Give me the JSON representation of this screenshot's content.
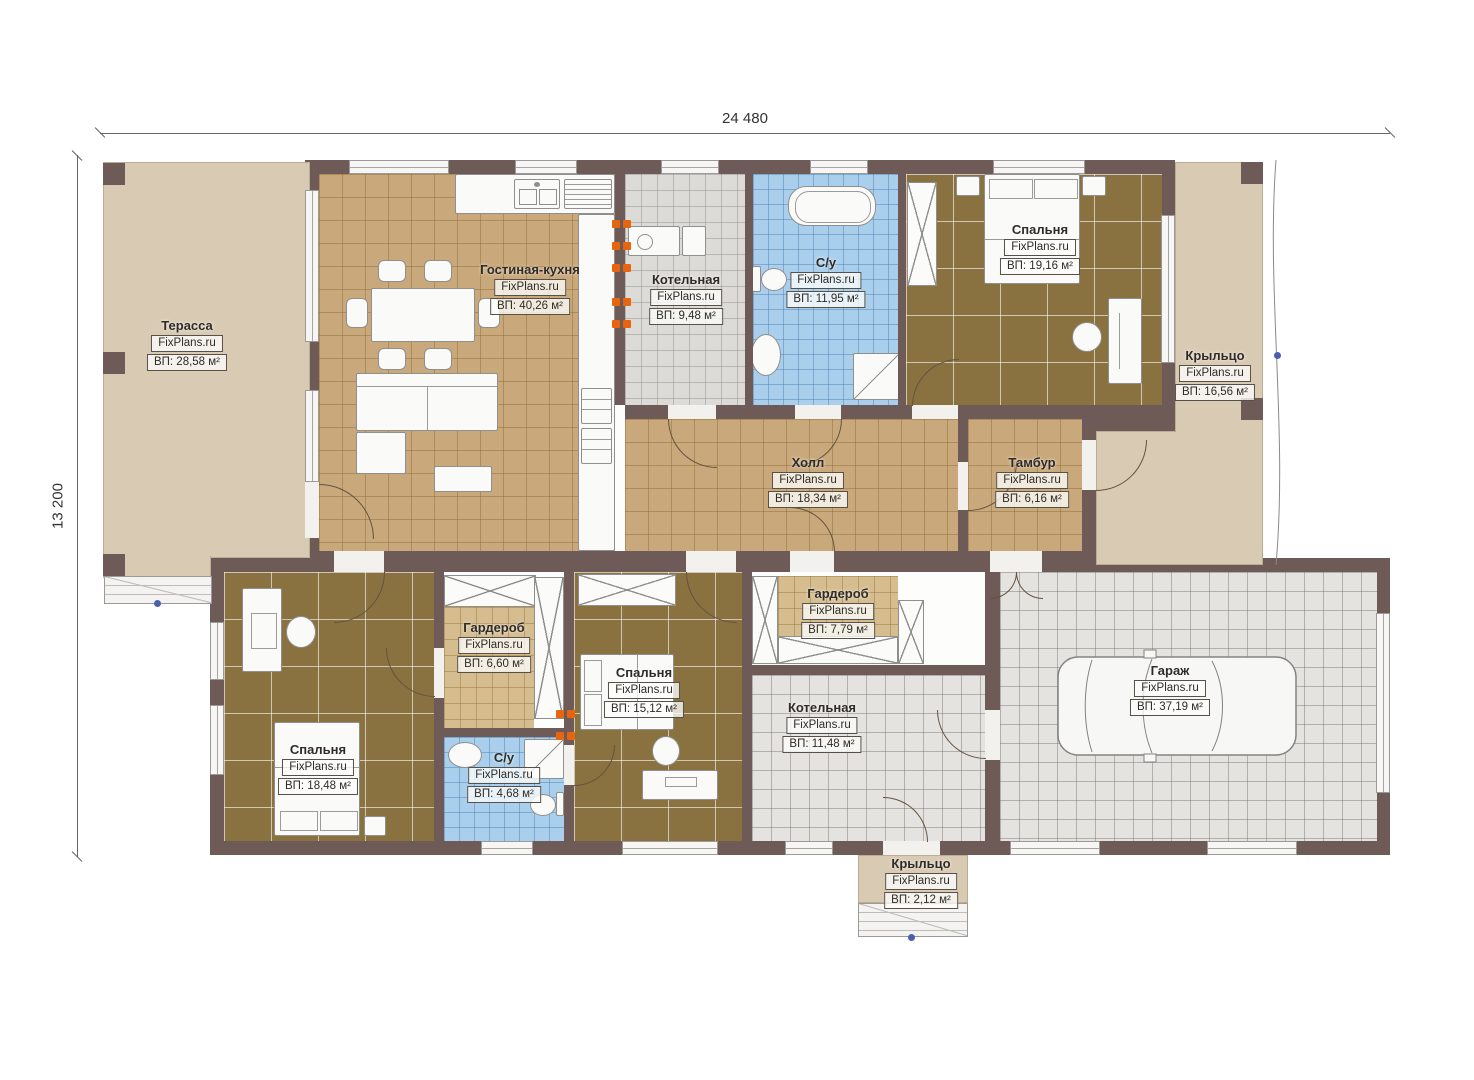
{
  "watermark": "FixPlans.ru",
  "dimensions": {
    "width": "24 480",
    "height": "13 200"
  },
  "rooms": [
    {
      "name": "Терасса",
      "area": "ВП: 28,58 м²"
    },
    {
      "name": "Гостиная-кухня",
      "area": "ВП: 40,26 м²"
    },
    {
      "name": "Котельная",
      "area": "ВП: 9,48 м²"
    },
    {
      "name": "С/у",
      "area": "ВП: 11,95 м²"
    },
    {
      "name": "Спальня",
      "area": "ВП: 19,16 м²"
    },
    {
      "name": "Крыльцо",
      "area": "ВП: 16,56 м²"
    },
    {
      "name": "Холл",
      "area": "ВП: 18,34 м²"
    },
    {
      "name": "Тамбур",
      "area": "ВП: 6,16 м²"
    },
    {
      "name": "Спальня",
      "area": "ВП: 18,48 м²"
    },
    {
      "name": "Гардероб",
      "area": "ВП: 6,60 м²"
    },
    {
      "name": "С/у",
      "area": "ВП: 4,68 м²"
    },
    {
      "name": "Спальня",
      "area": "ВП: 15,12 м²"
    },
    {
      "name": "Гардероб",
      "area": "ВП: 7,79 м²"
    },
    {
      "name": "Котельная",
      "area": "ВП: 11,48 м²"
    },
    {
      "name": "Гараж",
      "area": "ВП: 37,19 м²"
    },
    {
      "name": "Крыльцо",
      "area": "ВП: 2,12 м²"
    }
  ]
}
